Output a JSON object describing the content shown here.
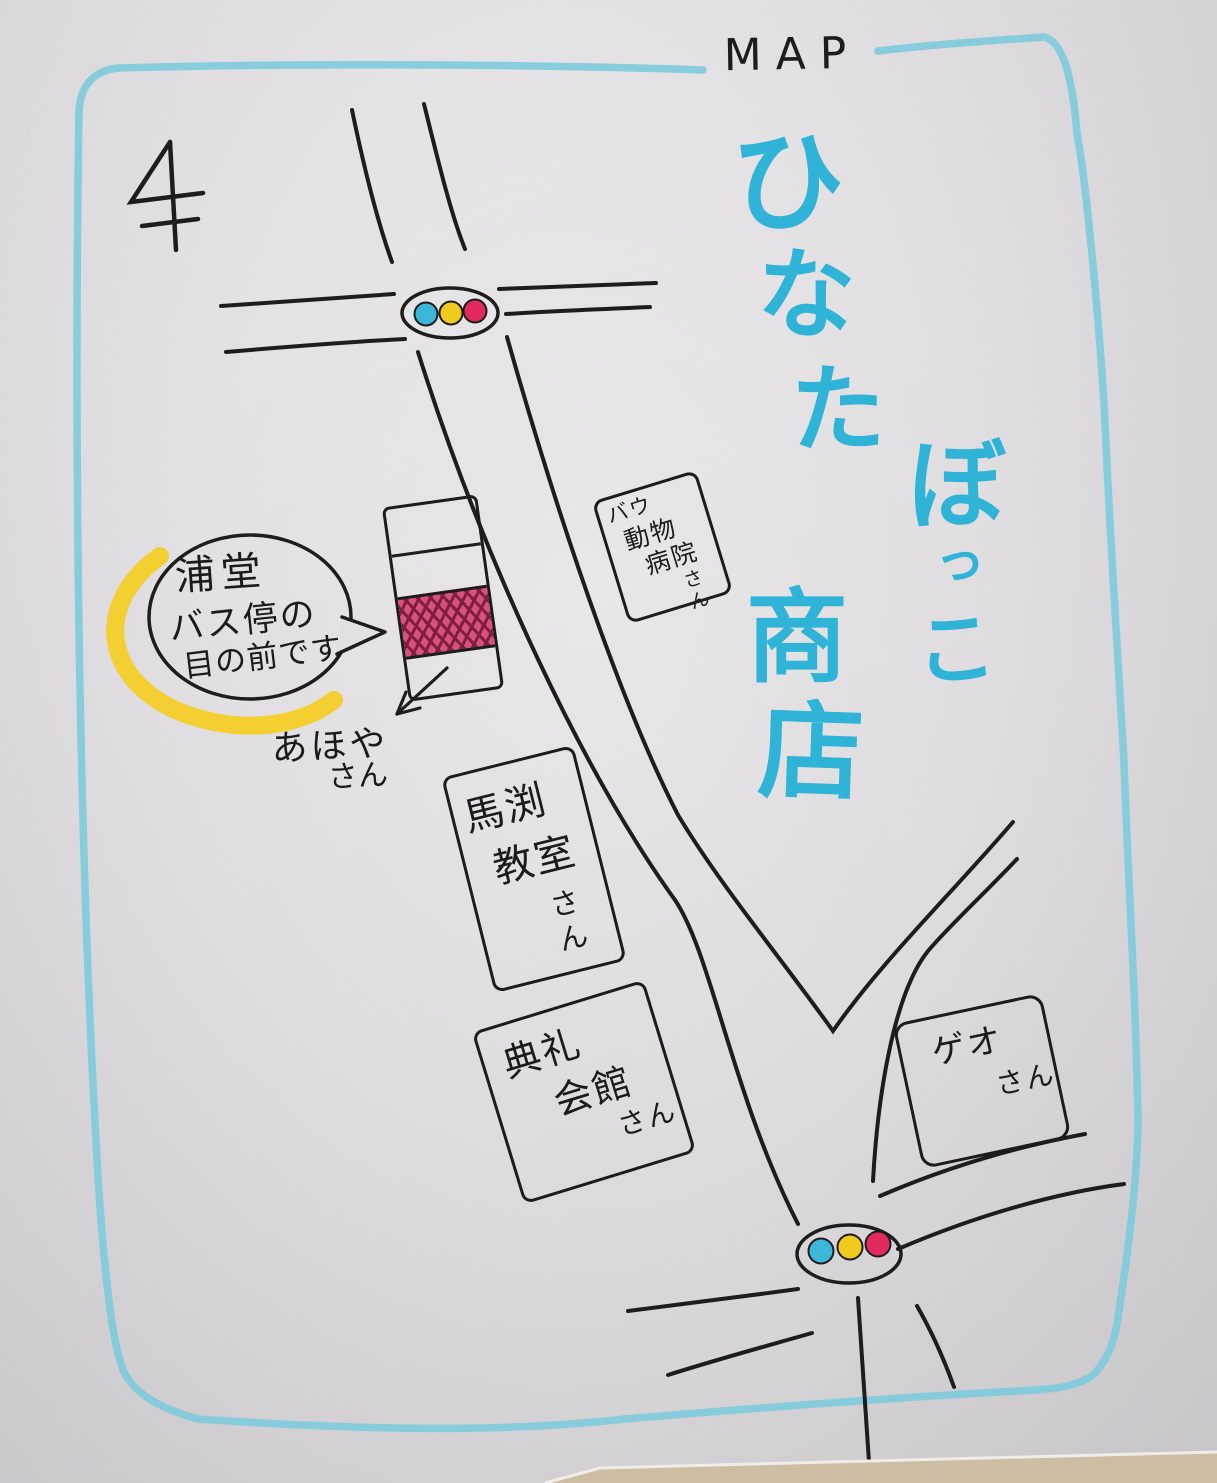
{
  "map": {
    "corner_label": "MAP",
    "north_mark": "4",
    "title": {
      "text": "ひなたぼっこ商店",
      "chars": [
        "ひ",
        "な",
        "た",
        "ぼ",
        "っ",
        "こ",
        "商",
        "店"
      ]
    },
    "callout": {
      "line1": "浦堂",
      "line2": "バス停の",
      "line3": "目の前です"
    },
    "shop_note": {
      "line1": "あほや",
      "line2": "さん"
    },
    "buildings": {
      "bau": {
        "line1": "バウ",
        "line2": "動物",
        "line3": "病院",
        "line4": "さん"
      },
      "mabuchi": {
        "line1": "馬渕",
        "line2": "教室",
        "line3": "さん"
      },
      "tenrei": {
        "line1": "典礼",
        "line2": "会館",
        "line3": "さん"
      },
      "geo": {
        "line1": "ゲオ",
        "line2": "さん"
      }
    },
    "traffic_lights": {
      "count": 2,
      "dot_order": [
        "blue",
        "yellow",
        "red"
      ]
    },
    "colors": {
      "border_blue": "#7fcbdc",
      "title_blue": "#2fb4d8",
      "ink_black": "#1d1d1d",
      "signal_blue": "#3cb6d9",
      "signal_yellow": "#f0cb1e",
      "signal_red": "#e22a5e",
      "hatch_pink": "#d9507a",
      "hatch_line": "#7d1f3e",
      "highlight_yellow": "#f3cd27",
      "paper_gray": "#e2e0e1",
      "table_tan": "#cdbda2"
    }
  }
}
